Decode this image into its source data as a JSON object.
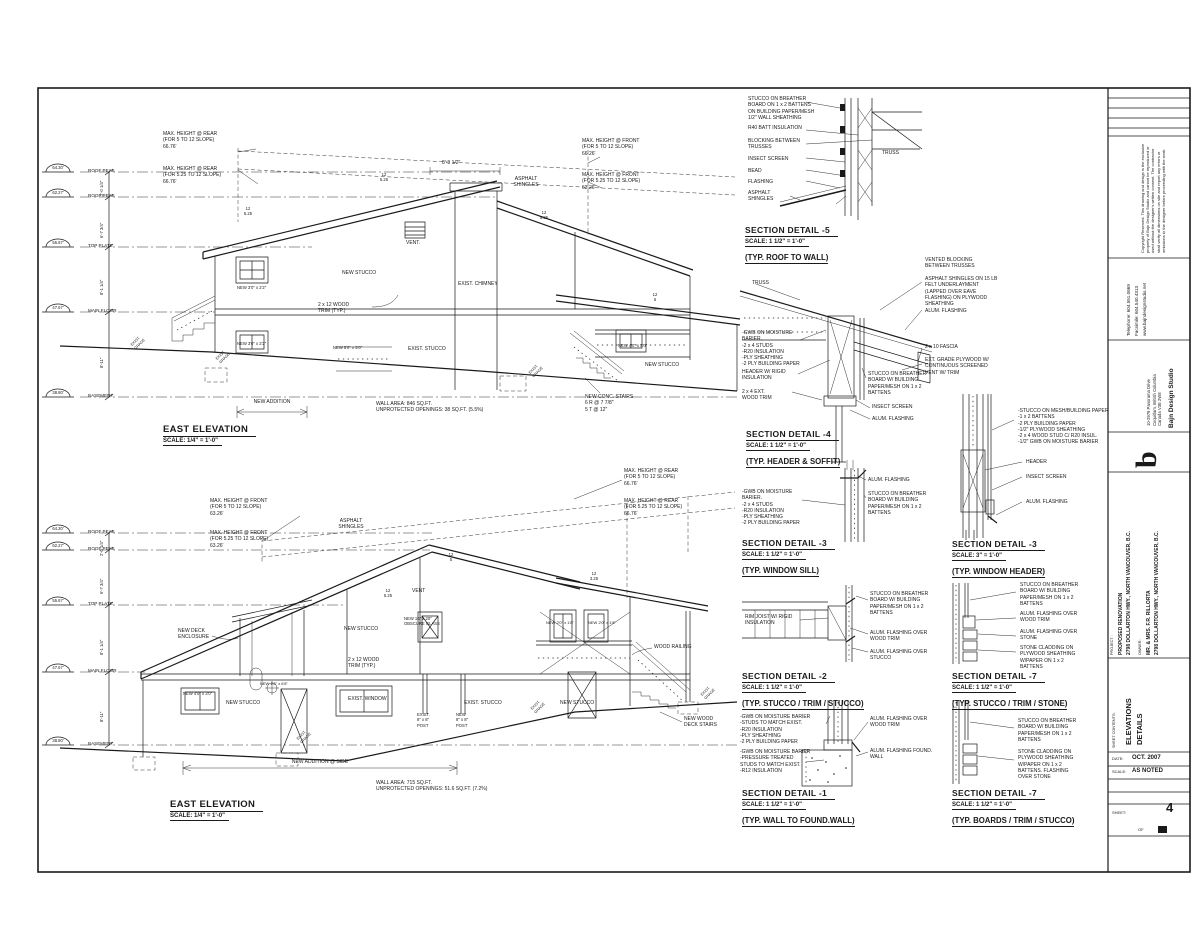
{
  "colors": {
    "ink": "#1a1a1a",
    "paper": "#ffffff"
  },
  "titleblock": {
    "disclaimer": "Copyright Reserved.\nThis drawing and design is the exclusive property of Bajn Design Studio and cannot be reproduced or used without the designer's written consent. The contractor shall verify all dimensions on site and report any errors or omissions to the designer before proceeding with the work.",
    "phone": "Telephone: 604.551.0669",
    "fax": "Facsimile: 604.540.4313",
    "web": "www.bajndesignstudio.net",
    "firm": "Bajn Design Studio",
    "firm_addr": "10-2979 Panorama Drive\nCoquitlam, British Columbia\nCanada V3E 2W8",
    "logo": "b",
    "project_label": "PROJECT :",
    "project": "PROPOSED RENOVATION\n2798 DOLLARTON HWY., NORTH VANCOUVER, B.C.",
    "owner_label": "OWNER:",
    "owner": "MR. & MRS. F.R. RILLORTA\n2798 DOLLARTON HWY., NORTH VANCOUVER, B.C.",
    "contents_label": "SHEET CONTENTS:",
    "contents": "ELEVATIONS\nDETAILS",
    "date_label": "DATE:",
    "date": "OCT. 2007",
    "scale_label": "SCALE:",
    "scale": "AS NOTED",
    "sheet_label": "SHEET:",
    "sheet_no": "4",
    "of_label": "OF"
  },
  "elevations": [
    {
      "title": "EAST ELEVATION",
      "scale": "SCALE: 1/4\" = 1'-0\"",
      "annotations": [
        {
          "t": "MAX. HEIGHT @ REAR\n(FOR 5 TO 12 SLOPE)\n66.76'",
          "x": 163,
          "y": 131
        },
        {
          "t": "MAX. HEIGHT @ REAR\n(FOR 5.25 TO 12 SLOPE)\n66.76'",
          "x": 163,
          "y": 166
        },
        {
          "t": "MAX. HEIGHT @ FRONT\n(FOR 5 TO 12 SLOPE)\n66.26'",
          "x": 582,
          "y": 138
        },
        {
          "t": "MAX. HEIGHT @ FRONT\n(FOR 5.25 TO 12 SLOPE)\n63.26'",
          "x": 582,
          "y": 172
        },
        {
          "t": "8'-3 1/2\"",
          "x": 442,
          "y": 160
        },
        {
          "t": "ASPHALT\nSHINGLES",
          "x": 505,
          "y": 176,
          "a": "center",
          "w": 42
        },
        {
          "t": "VENT.",
          "x": 406,
          "y": 240
        },
        {
          "t": "NEW STUCCO",
          "x": 342,
          "y": 270
        },
        {
          "t": "EXIST. CHIMNEY",
          "x": 458,
          "y": 281
        },
        {
          "t": "2 x 12 WOOD\nTRIM (TYP.)",
          "x": 318,
          "y": 302
        },
        {
          "t": "NEW 3'0\" x 2'2\"",
          "x": 237,
          "y": 285,
          "s": 4.2
        },
        {
          "t": "NEW 3'0\" x 2'2\"",
          "x": 237,
          "y": 341,
          "s": 4.2
        },
        {
          "t": "NEW 5'0\" x 5'0\"",
          "x": 333,
          "y": 345,
          "s": 4.2
        },
        {
          "t": "EXIST. STUCCO",
          "x": 408,
          "y": 346
        },
        {
          "t": "NEW 4'0\" x 3'0\"",
          "x": 618,
          "y": 343,
          "s": 4.2
        },
        {
          "t": "NEW STUCCO",
          "x": 645,
          "y": 362
        },
        {
          "t": "NEW CONC. STAIRS\n6 R @ 7 7/8\"\n5 T @ 12\"",
          "x": 585,
          "y": 394
        },
        {
          "t": "NEW ADDITION",
          "x": 232,
          "y": 399,
          "w": 80,
          "a": "center"
        },
        {
          "t": "WALL AREA: 846 SQ.FT.\nUNPROTECTED OPENINGS: 38 SQ.FT. (5.5%)",
          "x": 376,
          "y": 401
        },
        {
          "t": "64.30'",
          "x": 44,
          "y": 165,
          "w": 28,
          "a": "center",
          "s": 4.2
        },
        {
          "t": "ROOF PEAK",
          "x": 88,
          "y": 168,
          "s": 4.6
        },
        {
          "t": "62.27'",
          "x": 44,
          "y": 190,
          "w": 28,
          "a": "center",
          "s": 4.2
        },
        {
          "t": "ROOF PEAK",
          "x": 88,
          "y": 193,
          "s": 4.6
        },
        {
          "t": "55.67'",
          "x": 44,
          "y": 240,
          "w": 28,
          "a": "center",
          "s": 4.2
        },
        {
          "t": "TOP PLATE",
          "x": 88,
          "y": 243,
          "s": 4.6
        },
        {
          "t": "47.67'",
          "x": 44,
          "y": 305,
          "w": 28,
          "a": "center",
          "s": 4.2
        },
        {
          "t": "MAIN FLOOR",
          "x": 88,
          "y": 308,
          "s": 4.6
        },
        {
          "t": "38.80'",
          "x": 44,
          "y": 390,
          "w": 28,
          "a": "center",
          "s": 4.2
        },
        {
          "t": "BASEMENT",
          "x": 88,
          "y": 393,
          "s": 4.6
        },
        {
          "t": "2'-0 1/4\"",
          "x": 99,
          "y": 196,
          "r": 1,
          "s": 4.2
        },
        {
          "t": "6'-7 3/4\"",
          "x": 99,
          "y": 238,
          "r": 1,
          "s": 4.2
        },
        {
          "t": "8'-1 1/4\"",
          "x": 99,
          "y": 295,
          "r": 1,
          "s": 4.2
        },
        {
          "t": "8'-11\"",
          "x": 99,
          "y": 368,
          "r": 1,
          "s": 4.2
        },
        {
          "t": "12\n5.25",
          "x": 376,
          "y": 172,
          "a": "center",
          "w": 16,
          "s": 4.2
        },
        {
          "t": "12\n5.25",
          "x": 240,
          "y": 206,
          "a": "center",
          "w": 16,
          "s": 4.2
        },
        {
          "t": "12\n5.25",
          "x": 536,
          "y": 210,
          "a": "center",
          "w": 16,
          "s": 4.2
        },
        {
          "t": "12\n5",
          "x": 648,
          "y": 292,
          "a": "center",
          "w": 14,
          "s": 4.2
        },
        {
          "t": "EXIST.\nGRADE",
          "x": 130,
          "y": 344,
          "r": 2
        },
        {
          "t": "EXIST.\nGRADE",
          "x": 215,
          "y": 358,
          "r": 2
        },
        {
          "t": "EXIST.\nGRADE",
          "x": 528,
          "y": 372,
          "r": 2
        }
      ]
    },
    {
      "title": "EAST ELEVATION",
      "scale": "SCALE: 1/4\" = 1'-0\"",
      "annotations": [
        {
          "t": "MAX. HEIGHT @ FRONT\n(FOR 5 TO 12 SLOPE)\n63.26'",
          "x": 210,
          "y": 498
        },
        {
          "t": "MAX. HEIGHT @ FRONT\n(FOR 5.25 TO 12 SLOPE)\n63.26'",
          "x": 210,
          "y": 530
        },
        {
          "t": "MAX. HEIGHT @ REAR\n(FOR 5 TO 12 SLOPE)\n66.76'",
          "x": 624,
          "y": 468
        },
        {
          "t": "MAX. HEIGHT @ REAR\n(FOR 5.25 TO 12 SLOPE)\n66.76'",
          "x": 624,
          "y": 498
        },
        {
          "t": "ASPHALT\nSHINGLES",
          "x": 330,
          "y": 518,
          "a": "center",
          "w": 42
        },
        {
          "t": "NEW STUCCO",
          "x": 344,
          "y": 626
        },
        {
          "t": "NEW DECK\nENCLOSURE",
          "x": 178,
          "y": 628
        },
        {
          "t": "NEW 16\" x 20\"\nOBSCURE GLASS",
          "x": 404,
          "y": 616,
          "s": 4.2
        },
        {
          "t": "VENT",
          "x": 412,
          "y": 588
        },
        {
          "t": "NEW 2'0\" x 1'8\"",
          "x": 546,
          "y": 620,
          "s": 4
        },
        {
          "t": "NEW 2'0\" x 1'8\"",
          "x": 588,
          "y": 620,
          "s": 4
        },
        {
          "t": "2 x 12 WOOD\nTRIM (TYP.)",
          "x": 348,
          "y": 657
        },
        {
          "t": "WOOD RAILING",
          "x": 654,
          "y": 644
        },
        {
          "t": "NEW 4'0\" x 3'0\"",
          "x": 183,
          "y": 691,
          "s": 4.2
        },
        {
          "t": "NEW STUCCO",
          "x": 226,
          "y": 700
        },
        {
          "t": "NEW 2'8\" x 6'8\"",
          "x": 260,
          "y": 681,
          "s": 4
        },
        {
          "t": "EXIST. WINDOW",
          "x": 348,
          "y": 696
        },
        {
          "t": "EXIST. STUCCO",
          "x": 464,
          "y": 700
        },
        {
          "t": "NEW STUCCO",
          "x": 560,
          "y": 700
        },
        {
          "t": "EXIST.\n8\" x 8\"\nPOST",
          "x": 417,
          "y": 712,
          "s": 4.2
        },
        {
          "t": "NEW\n8\" x 8\"\nPOST",
          "x": 456,
          "y": 712,
          "s": 4.2
        },
        {
          "t": "NEW WOOD\nDECK STAIRS",
          "x": 684,
          "y": 716
        },
        {
          "t": "NEW ADDITION @ SIDE",
          "x": 270,
          "y": 759,
          "w": 100,
          "a": "center"
        },
        {
          "t": "WALL AREA: 715 SQ.FT.\nUNPROTECTED OPENINGS: 51.6 SQ.FT. (7.2%)",
          "x": 376,
          "y": 780
        },
        {
          "t": "64.30'",
          "x": 44,
          "y": 526,
          "w": 28,
          "a": "center",
          "s": 4.2
        },
        {
          "t": "ROOF PEAK",
          "x": 88,
          "y": 529,
          "s": 4.6
        },
        {
          "t": "62.27'",
          "x": 44,
          "y": 543,
          "w": 28,
          "a": "center",
          "s": 4.2
        },
        {
          "t": "ROOF PEAK",
          "x": 88,
          "y": 546,
          "s": 4.6
        },
        {
          "t": "55.67'",
          "x": 44,
          "y": 598,
          "w": 28,
          "a": "center",
          "s": 4.2
        },
        {
          "t": "TOP PLATE",
          "x": 88,
          "y": 601,
          "s": 4.6
        },
        {
          "t": "47.67'",
          "x": 44,
          "y": 665,
          "w": 28,
          "a": "center",
          "s": 4.2
        },
        {
          "t": "MAIN FLOOR",
          "x": 88,
          "y": 668,
          "s": 4.6
        },
        {
          "t": "38.80'",
          "x": 44,
          "y": 738,
          "w": 28,
          "a": "center",
          "s": 4.2
        },
        {
          "t": "BASEMENT",
          "x": 88,
          "y": 741,
          "s": 4.6
        },
        {
          "t": "2'-0 1/4\"",
          "x": 99,
          "y": 556,
          "r": 1,
          "s": 4.2
        },
        {
          "t": "6'-7 3/4\"",
          "x": 99,
          "y": 594,
          "r": 1,
          "s": 4.2
        },
        {
          "t": "8'-1 1/4\"",
          "x": 99,
          "y": 655,
          "r": 1,
          "s": 4.2
        },
        {
          "t": "8'-11\"",
          "x": 99,
          "y": 722,
          "r": 1,
          "s": 4.2
        },
        {
          "t": "12\n5",
          "x": 444,
          "y": 552,
          "a": "center",
          "w": 14,
          "s": 4.2
        },
        {
          "t": "12\n3.25",
          "x": 584,
          "y": 571,
          "a": "center",
          "w": 20,
          "s": 4.2
        },
        {
          "t": "12\n5.25",
          "x": 378,
          "y": 588,
          "a": "center",
          "w": 20,
          "s": 4.2
        },
        {
          "t": "EXIST.\nGRADE",
          "x": 296,
          "y": 738,
          "r": 2
        },
        {
          "t": "EXIST.\nGRADE",
          "x": 530,
          "y": 708,
          "r": 2
        },
        {
          "t": "EXIST.\nGRADE",
          "x": 700,
          "y": 694,
          "r": 2
        }
      ]
    }
  ],
  "details": [
    {
      "title": "SECTION DETAIL -5",
      "scale": "SCALE: 1 1/2\" = 1'-0\"",
      "sub": "(TYP. ROOF TO WALL)",
      "callouts": [
        {
          "t": "STUCCO ON BREATHER\nBOARD ON 1 x 2 BATTENS\nON BUILDING PAPER/MESH\n1/2\" WALL SHEATHING",
          "x": 748,
          "y": 96
        },
        {
          "t": "R40 BATT INSULATION",
          "x": 748,
          "y": 125
        },
        {
          "t": "BLOCKING BETWEEN\nTRUSSES",
          "x": 748,
          "y": 138
        },
        {
          "t": "INSECT SCREEN",
          "x": 748,
          "y": 156
        },
        {
          "t": "BEAD",
          "x": 748,
          "y": 168
        },
        {
          "t": "FLASHING",
          "x": 748,
          "y": 179
        },
        {
          "t": "ASPHALT\nSHINGLES",
          "x": 748,
          "y": 190
        },
        {
          "t": "TRUSS",
          "x": 882,
          "y": 150
        }
      ]
    },
    {
      "title": "SECTION DETAIL -4",
      "scale": "SCALE: 1 1/2\" = 1'-0\"",
      "sub": "(TYP. HEADER & SOFFIT)",
      "callouts": [
        {
          "t": "TRUSS",
          "x": 752,
          "y": 280
        },
        {
          "t": "-GWB ON MOISTURE\nBARIER.\n-2 x 4 STUDS\n-R20 INSULATION\n-PLY SHEATHING\n-2 PLY BUILDING PAPER",
          "x": 742,
          "y": 330
        },
        {
          "t": "HEADER W/ RIGID\nINSULATION",
          "x": 742,
          "y": 369
        },
        {
          "t": "2 x 4 EXT.\nWOOD TRIM",
          "x": 742,
          "y": 389
        },
        {
          "t": "VENTED BLOCKING\nBETWEEN TRUSSES",
          "x": 925,
          "y": 257
        },
        {
          "t": "ASPHALT SHINGLES ON 15 LB\nFELT UNDERLAYMENT\n(LAPPED OVER EAVE\nFLASHING) ON PLYWOOD\nSHEATHING",
          "x": 925,
          "y": 276
        },
        {
          "t": "ALUM. FLASHING",
          "x": 925,
          "y": 308
        },
        {
          "t": "2 x 10 FASCIA",
          "x": 925,
          "y": 344
        },
        {
          "t": "EXT. GRADE PLYWOOD W/\nCONTINUOUS SCREENED\nVENT W/ TRIM",
          "x": 925,
          "y": 357
        },
        {
          "t": "STUCCO ON BREATHER\nBOARD W/ BUILDING\nPAPER/MESH ON 1 x 2\nBATTENS",
          "x": 868,
          "y": 371
        },
        {
          "t": "INSECT SCREEN",
          "x": 872,
          "y": 404
        },
        {
          "t": "ALUM. FLASHING",
          "x": 872,
          "y": 416
        }
      ]
    },
    {
      "title": "SECTION DETAIL -3",
      "scale": "SCALE: 1 1/2\" = 1'-0\"",
      "sub": "(TYP. WINDOW SILL)",
      "callouts": [
        {
          "t": "-GWB ON MOISTURE\nBARIER.\n-2 x 4 STUDS\n-R20 INSULATION\n-PLY SHEATHING\n-2 PLY BUILDING PAPER",
          "x": 742,
          "y": 489
        },
        {
          "t": "ALUM. FLASHING",
          "x": 868,
          "y": 477
        },
        {
          "t": "STUCCO ON BREATHER\nBOARD W/ BUILDING\nPAPER/MESH ON 1 x 2\nBATTENS",
          "x": 868,
          "y": 491
        }
      ]
    },
    {
      "title": "SECTION DETAIL -3",
      "scale": "SCALE: 3\" = 1'-0\"",
      "sub": "(TYP. WINDOW HEADER)",
      "callouts": [
        {
          "t": "-STUCCO ON MESH/BUILDING PAPER\n-1 x 2 BATTENS\n-2 PLY BUILDING PAPER\n-1/2\" PLYWOOD SHEATHING\n-2 x 4 WOOD STUD C/ R20 INSUL.\n-1/2\" GWB ON MOISTURE BARIER",
          "x": 1018,
          "y": 408
        },
        {
          "t": "HEADER",
          "x": 1026,
          "y": 459
        },
        {
          "t": "INSECT SCREEN",
          "x": 1026,
          "y": 474
        },
        {
          "t": "ALUM. FLASHING",
          "x": 1026,
          "y": 499
        }
      ]
    },
    {
      "title": "SECTION DETAIL -2",
      "scale": "SCALE: 1 1/2\" = 1'-0\"",
      "sub": "(TYP. STUCCO / TRIM / STUCCO)",
      "callouts": [
        {
          "t": "RIM JOIST W/ RIGID\nINSULATION",
          "x": 745,
          "y": 614
        },
        {
          "t": "STUCCO ON BREATHER\nBOARD W/ BUILDING\nPAPER/MESH ON 1 x 2\nBATTENS",
          "x": 870,
          "y": 591
        },
        {
          "t": "ALUM. FLASHING OVER\nWOOD TRIM",
          "x": 870,
          "y": 630
        },
        {
          "t": "ALUM. FLASHING OVER\nSTUCCO",
          "x": 870,
          "y": 649
        }
      ]
    },
    {
      "title": "SECTION DETAIL -7",
      "scale": "SCALE: 1 1/2\" = 1'-0\"",
      "sub": "(TYP. STUCCO / TRIM / STONE)",
      "callouts": [
        {
          "t": "STUCCO ON BREATHER\nBOARD W/ BUILDING\nPAPER/MESH ON 1 x 2\nBATTENS",
          "x": 1020,
          "y": 582
        },
        {
          "t": "ALUM. FLASHING OVER\nWOOD TRIM",
          "x": 1020,
          "y": 611
        },
        {
          "t": "ALUM. FLASHING OVER\nSTONE",
          "x": 1020,
          "y": 629
        },
        {
          "t": "STONE CLADDING ON\nPLYWOOD SHEATHING\nW/PAPER ON 1 x 2\nBATTENS",
          "x": 1020,
          "y": 645
        }
      ]
    },
    {
      "title": "SECTION DETAIL -1",
      "scale": "SCALE: 1 1/2\" = 1'-0\"",
      "sub": "(TYP. WALL TO FOUND.WALL)",
      "callouts": [
        {
          "t": "-GWB ON MOISTURE BARIER\n-STUDS TO MATCH EXIST.\n-R20 INSULATION\n-PLY SHEATHING\n-2 PLY BUILDING PAPER",
          "x": 740,
          "y": 714
        },
        {
          "t": "-GWB ON MOISTURE BARIER\n-PRESSURE TREATED\nSTUDS TO MATCH EXIST.\n-R12 INSULATION",
          "x": 740,
          "y": 749
        },
        {
          "t": "ALUM. FLASHING OVER\nWOOD TRIM",
          "x": 870,
          "y": 716
        },
        {
          "t": "ALUM. FLASHING FOUND.\nWALL",
          "x": 870,
          "y": 748
        }
      ]
    },
    {
      "title": "SECTION DETAIL -7",
      "scale": "SCALE: 1 1/2\" = 1'-0\"",
      "sub": "(TYP. BOARDS / TRIM / STUCCO)",
      "callouts": [
        {
          "t": "STUCCO ON BREATHER\nBOARD W/ BUILDING\nPAPER/MESH ON 1 x 2\nBATTENS",
          "x": 1018,
          "y": 718
        },
        {
          "t": "STONE CLADDING ON\nPLYWOOD SHEATHING\nW/PAPER ON 1 x 2\nBATTENS. FLASHING\nOVER STONE",
          "x": 1018,
          "y": 749
        }
      ]
    }
  ]
}
